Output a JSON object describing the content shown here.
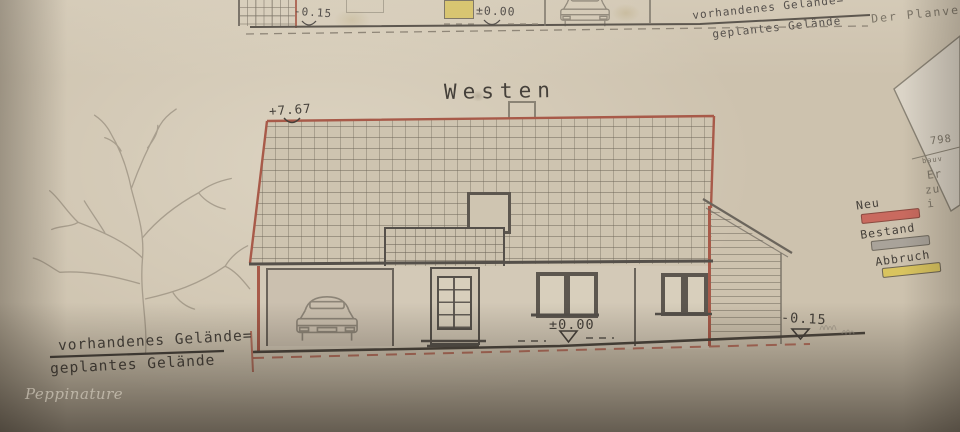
{
  "top_elevation": {
    "level_minus": "-0.15",
    "level_zero": "±0.00",
    "ground_line1": "vorhandenes Gelände=",
    "ground_line2": "geplantes Gelände",
    "planner_note": "Der Planverfa"
  },
  "west_elevation": {
    "title": "Westen",
    "ridge_level": "+7.67",
    "floor_level": "±0.00",
    "ground_level": "-0.15",
    "ground_line1": "vorhandenes Gelände=",
    "ground_line2": "geplantes Gelände"
  },
  "legend": {
    "items": [
      {
        "label": "Neu",
        "color": "#c96a5f"
      },
      {
        "label": "Bestand",
        "color": "#a9a39a"
      },
      {
        "label": "Abbruch",
        "color": "#d9c45f"
      }
    ]
  },
  "title_block": {
    "number_fragment": "798",
    "small_fragment": "bauv",
    "line1_fragment": "Er",
    "line2_fragment": "zu",
    "line3_fragment": "i"
  },
  "watermark": "Peppinature"
}
